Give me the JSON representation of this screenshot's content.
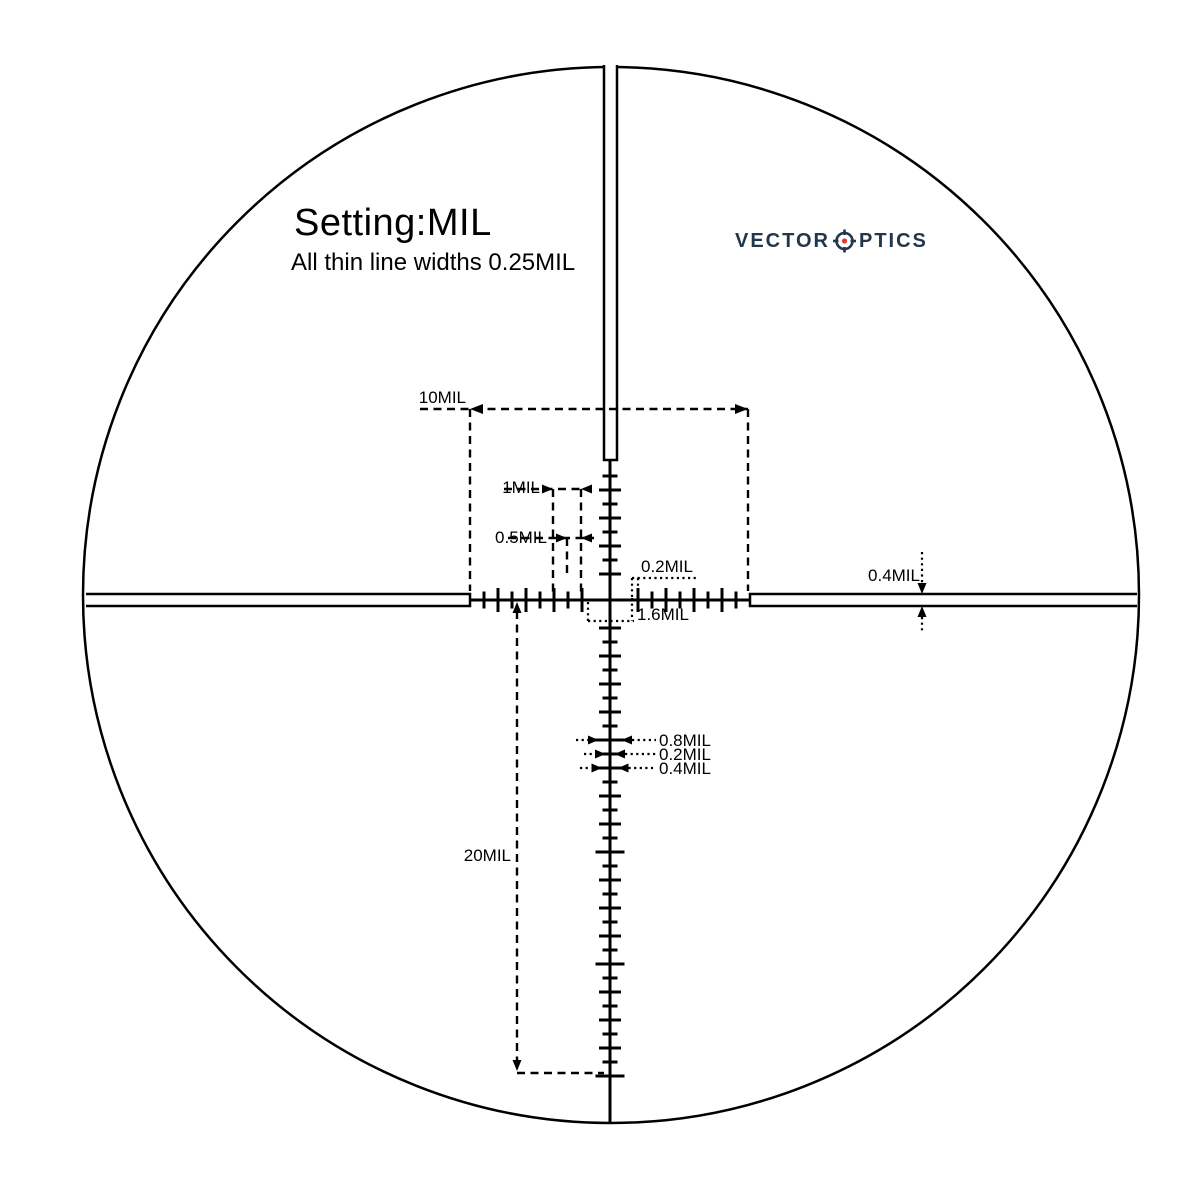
{
  "page": {
    "background": "#ffffff",
    "ink": "#000000"
  },
  "header": {
    "setting_title": "Setting:MIL",
    "subtitle": "All thin line widths 0.25MIL"
  },
  "logo": {
    "word1": "VECTOR",
    "word2": "PTICS",
    "color": "#20374d",
    "dot_color": "#e23b2e",
    "icon": "reticle-o-icon"
  },
  "annotations": {
    "horizontal_span": "10MIL",
    "one_mil": "1MIL",
    "half_mil": "0.5MIL",
    "tick_gap": "0.2MIL",
    "center_gap": "1.6MIL",
    "bar_thickness": "0.4MIL",
    "wide_tick_width": "0.8MIL",
    "small_tick_width": "0.2MIL",
    "medium_tick_width": "0.4MIL",
    "vertical_span": "20MIL"
  },
  "reticle": {
    "unit": "MIL",
    "center_x": 610,
    "center_y": 600,
    "circle_cx": 611,
    "circle_cy": 595,
    "circle_r": 528,
    "mil_px": 28,
    "post_inner_offset": 140,
    "h_ticks": {
      "first": 28,
      "step": 14,
      "count": 8,
      "int_len": 18,
      "half_len": 11
    },
    "up_ticks": {
      "first": 26,
      "step": 14,
      "count": 8,
      "int_len": 16,
      "half_len": 9
    },
    "down_ticks": {
      "first": 28,
      "step": 14,
      "count": 33,
      "int_len": 16,
      "half_len": 9,
      "wide_len": 23,
      "wide_every": 8
    }
  }
}
